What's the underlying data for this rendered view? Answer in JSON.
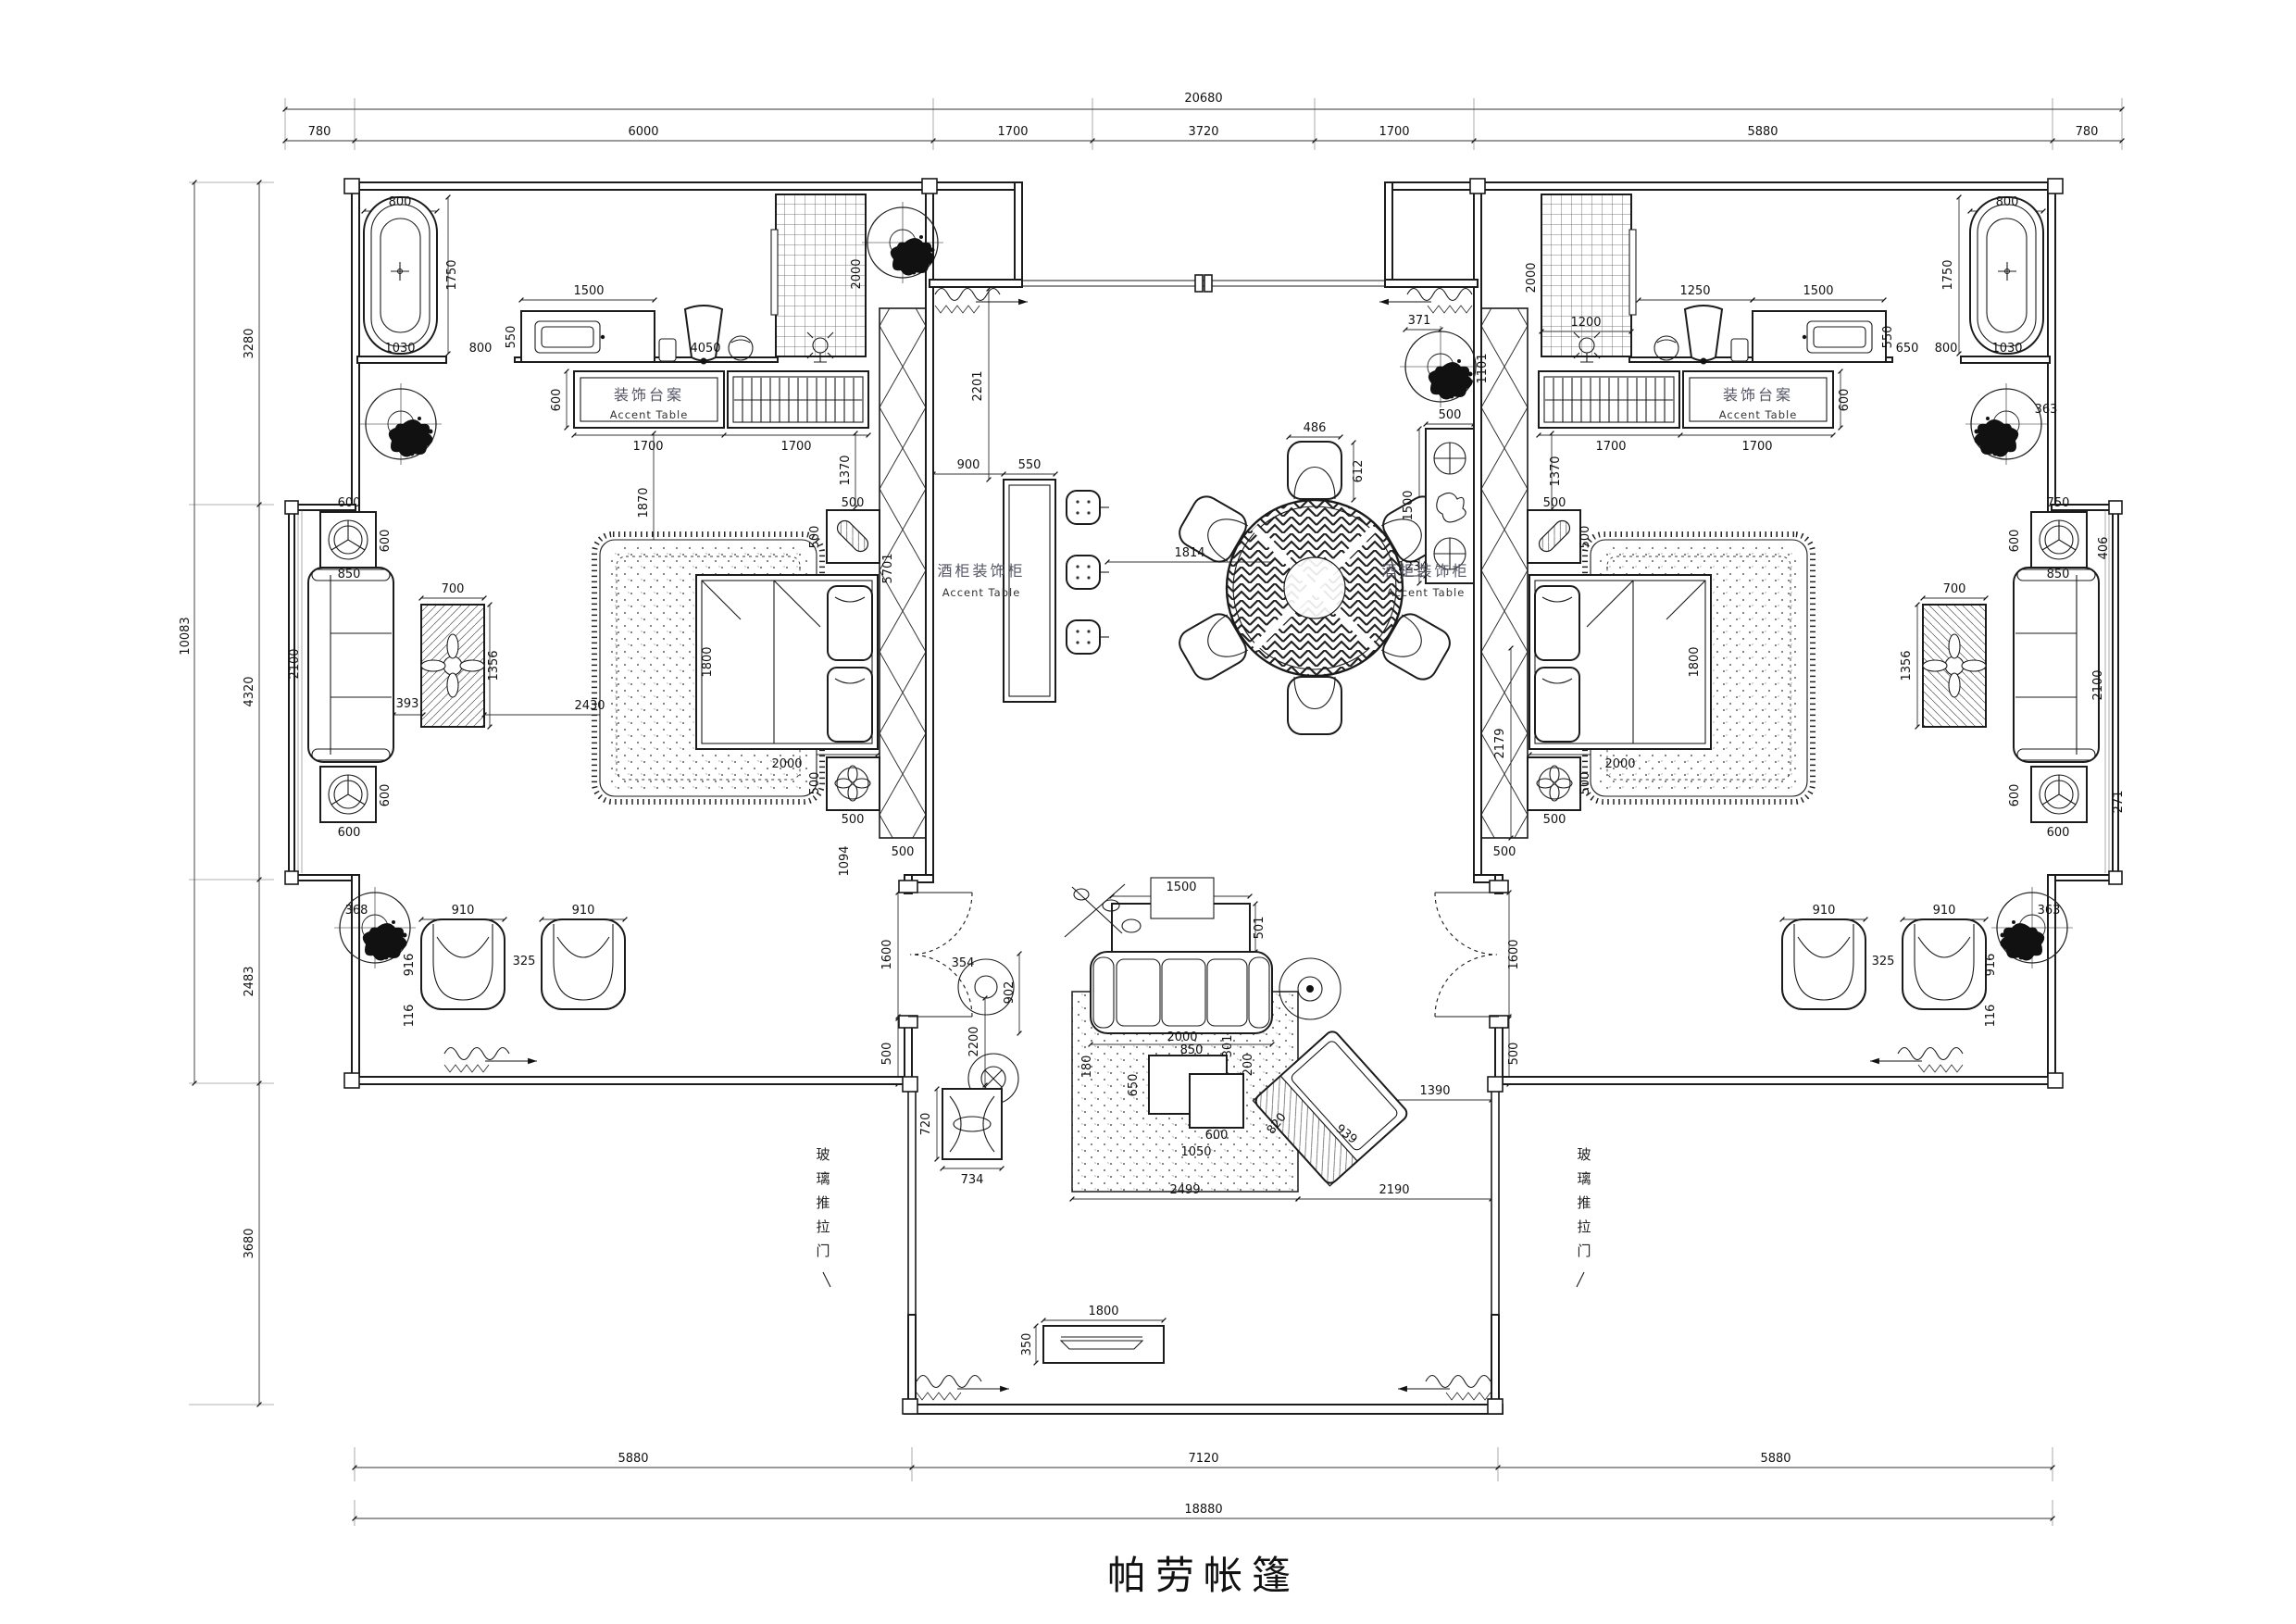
{
  "title": "帕劳帐篷",
  "labels": {
    "accent_table_cn": "装饰台案",
    "accent_table_en": "Accent Table",
    "deco_cabinet_cn": "酒柜装饰柜",
    "deco_cabinet_en": "Accent Table",
    "glass_door_chars": [
      "玻",
      "璃",
      "推",
      "拉",
      "门"
    ]
  },
  "dims": {
    "top": {
      "total": "20680",
      "segs": [
        "780",
        "6000",
        "1700",
        "3720",
        "1700",
        "5880",
        "780"
      ]
    },
    "left": {
      "total": "10083",
      "segs": [
        "3280",
        "4320",
        "2483",
        "3680"
      ]
    },
    "bottom": {
      "total": "18880",
      "segs": [
        "5880",
        "7120",
        "5880"
      ]
    },
    "v": {
      "d800": "800",
      "d1750": "1750",
      "d1030": "1030",
      "d550": "550",
      "d1500": "1500",
      "d4050": "4050",
      "d2000": "2000",
      "d600": "600",
      "d1700": "1700",
      "d1870": "1870",
      "d1370": "1370",
      "d500": "500",
      "d1800": "1800",
      "d1094": "1094",
      "d5701": "5701",
      "d2430": "2430",
      "d393": "393",
      "d850": "850",
      "d2100": "2100",
      "d700": "700",
      "d1356": "1356",
      "d368": "368",
      "d910": "910",
      "d325": "325",
      "d916": "916",
      "d116": "116",
      "d1600": "1600",
      "d2201": "2201",
      "d900": "900",
      "d1814": "1814",
      "d486": "486",
      "d612": "612",
      "d1234": "1234",
      "d371": "371",
      "d1101": "1101",
      "d2179": "2179",
      "d1200": "1200",
      "d1250": "1250",
      "d650": "650",
      "d363": "363",
      "d750": "750",
      "d406": "406",
      "d271": "271",
      "d501": "501",
      "d354": "354",
      "d902": "902",
      "d301": "301",
      "d200": "200",
      "d180": "180",
      "d1050": "1050",
      "d2200": "2200",
      "d720": "720",
      "d734": "734",
      "d2499": "2499",
      "d820": "820",
      "d939": "939",
      "d1390": "1390",
      "d2190": "2190",
      "d350": "350"
    }
  }
}
